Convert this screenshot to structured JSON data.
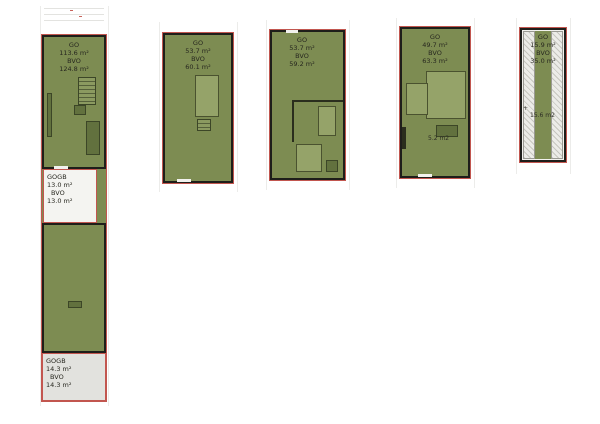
{
  "colors": {
    "plan_green": "#7d8c52",
    "room_light_green": "#95a369",
    "furniture_dark_green": "#62713e",
    "wall_black": "#1e1e1a",
    "outline_red": "#c2564f",
    "gogb_white_box": "#f4f4f1",
    "gogb_gray_box": "#e2e2de",
    "hatch_gray": "#ecece8"
  },
  "plans": [
    {
      "go_label": "GO",
      "go_value": "113.6 m²",
      "bvo_label": "BVO",
      "bvo_value": "124.8 m²",
      "gogb_top": {
        "label": "GOGB",
        "value": "13.0 m²",
        "bvo_label": "BVO",
        "bvo_value": "13.0 m²"
      },
      "gogb_bottom": {
        "label": "GOGB",
        "value": "14.3 m²",
        "bvo_label": "BVO",
        "bvo_value": "14.3 m²"
      }
    },
    {
      "go_label": "GO",
      "go_value": "53.7 m²",
      "bvo_label": "BVO",
      "bvo_value": "60.1 m²"
    },
    {
      "go_label": "GO",
      "go_value": "53.7 m²",
      "bvo_label": "BVO",
      "bvo_value": "59.2 m²"
    },
    {
      "go_label": "GO",
      "go_value": "49.7 m²",
      "bvo_label": "BVO",
      "bvo_value": "63.3 m²",
      "annotation": "5.2 m2"
    },
    {
      "go_label": "GO",
      "go_value": "15.9 m²",
      "bvo_label": "BVO",
      "bvo_value": "35.0 m²",
      "annotation": "15.6 m2"
    }
  ]
}
